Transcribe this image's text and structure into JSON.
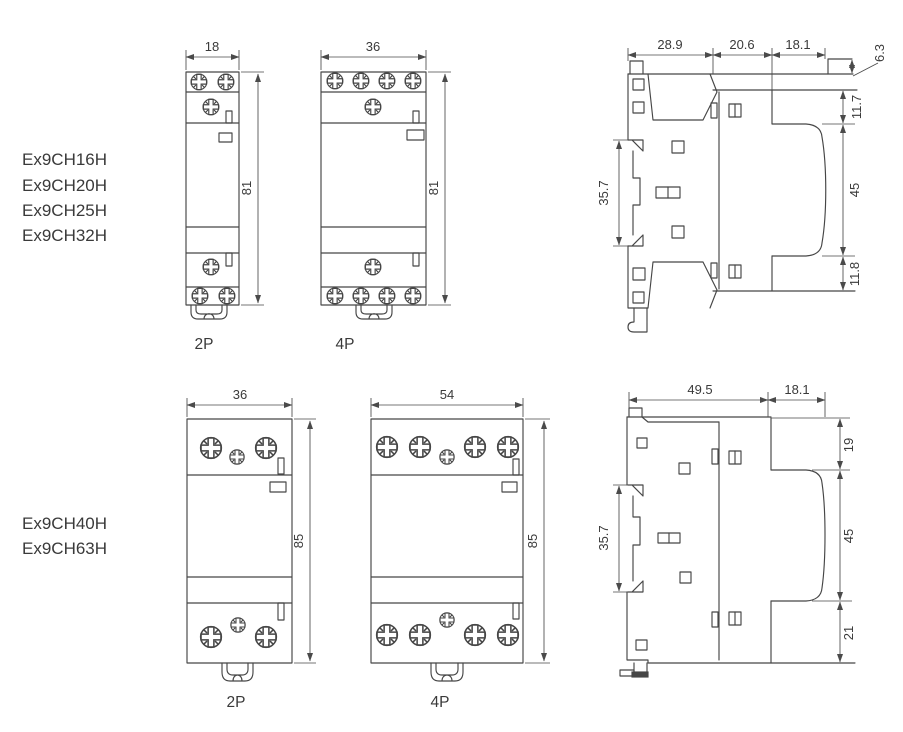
{
  "colors": {
    "background": "#ffffff",
    "line": "#464646",
    "text": "#3a3a3a"
  },
  "units": "mm",
  "model_groups": {
    "top": {
      "models": [
        "Ex9CH16H",
        "Ex9CH20H",
        "Ex9CH25H",
        "Ex9CH32H"
      ]
    },
    "bottom": {
      "models": [
        "Ex9CH40H",
        "Ex9CH63H"
      ]
    }
  },
  "top_row": {
    "front_2p": {
      "width": "18",
      "height": "81",
      "label": "2P"
    },
    "front_4p": {
      "width": "36",
      "height": "81",
      "label": "4P"
    },
    "side": {
      "d1": "28.9",
      "d2": "20.6",
      "d3": "18.1",
      "lip": "6.3",
      "step_top": "11.7",
      "face": "45",
      "step_bottom": "11.8",
      "din": "35.7"
    }
  },
  "bottom_row": {
    "front_2p": {
      "width": "36",
      "height": "85",
      "label": "2P"
    },
    "front_4p": {
      "width": "54",
      "height": "85",
      "label": "4P"
    },
    "side": {
      "d1": "49.5",
      "d2": "18.1",
      "step_top": "19",
      "face": "45",
      "step_bottom": "21",
      "din": "35.7"
    }
  }
}
